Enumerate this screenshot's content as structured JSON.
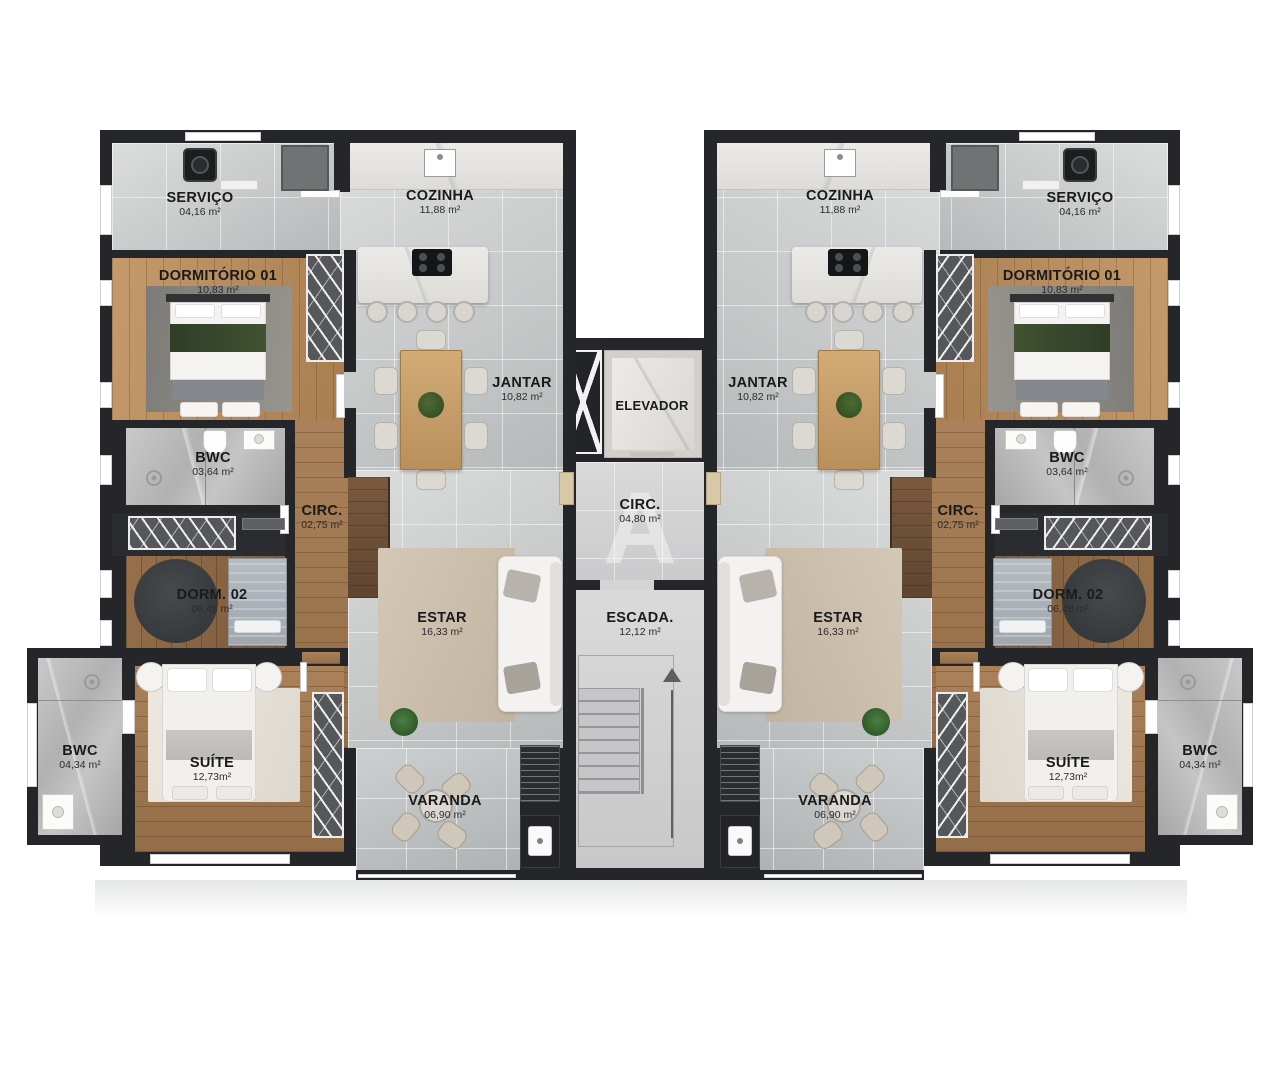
{
  "watermark": "A",
  "colors": {
    "wall": "#25262a",
    "tile_floor": "#c5c8c9",
    "wood_floor": "#a9815a",
    "rug_estar": "#cbbfad",
    "label_text": "#1a1a1a",
    "page_background": "#ffffff"
  },
  "rooms": {
    "servico": {
      "name": "SERVIÇO",
      "area": "04,16 m²"
    },
    "cozinha": {
      "name": "COZINHA",
      "area": "11,88 m²"
    },
    "dormitorio01": {
      "name": "DORMITÓRIO 01",
      "area": "10,83 m²"
    },
    "jantar": {
      "name": "JANTAR",
      "area": "10,82 m²"
    },
    "bwc_social": {
      "name": "BWC",
      "area": "03,64 m²"
    },
    "circ": {
      "name": "CIRC.",
      "area": "02,75 m²"
    },
    "dorm02": {
      "name": "DORM. 02",
      "area": "06,48 m²"
    },
    "estar": {
      "name": "ESTAR",
      "area": "16,33 m²"
    },
    "suite": {
      "name": "SUÍTE",
      "area": "12,73m²"
    },
    "bwc_suite": {
      "name": "BWC",
      "area": "04,34 m²"
    },
    "varanda": {
      "name": "VARANDA",
      "area": "06,90 m²"
    }
  },
  "core": {
    "elevador": {
      "name": "ELEVADOR"
    },
    "circ": {
      "name": "CIRC.",
      "area": "04,80 m²"
    },
    "escada": {
      "name": "ESCADA.",
      "area": "12,12 m²"
    }
  }
}
